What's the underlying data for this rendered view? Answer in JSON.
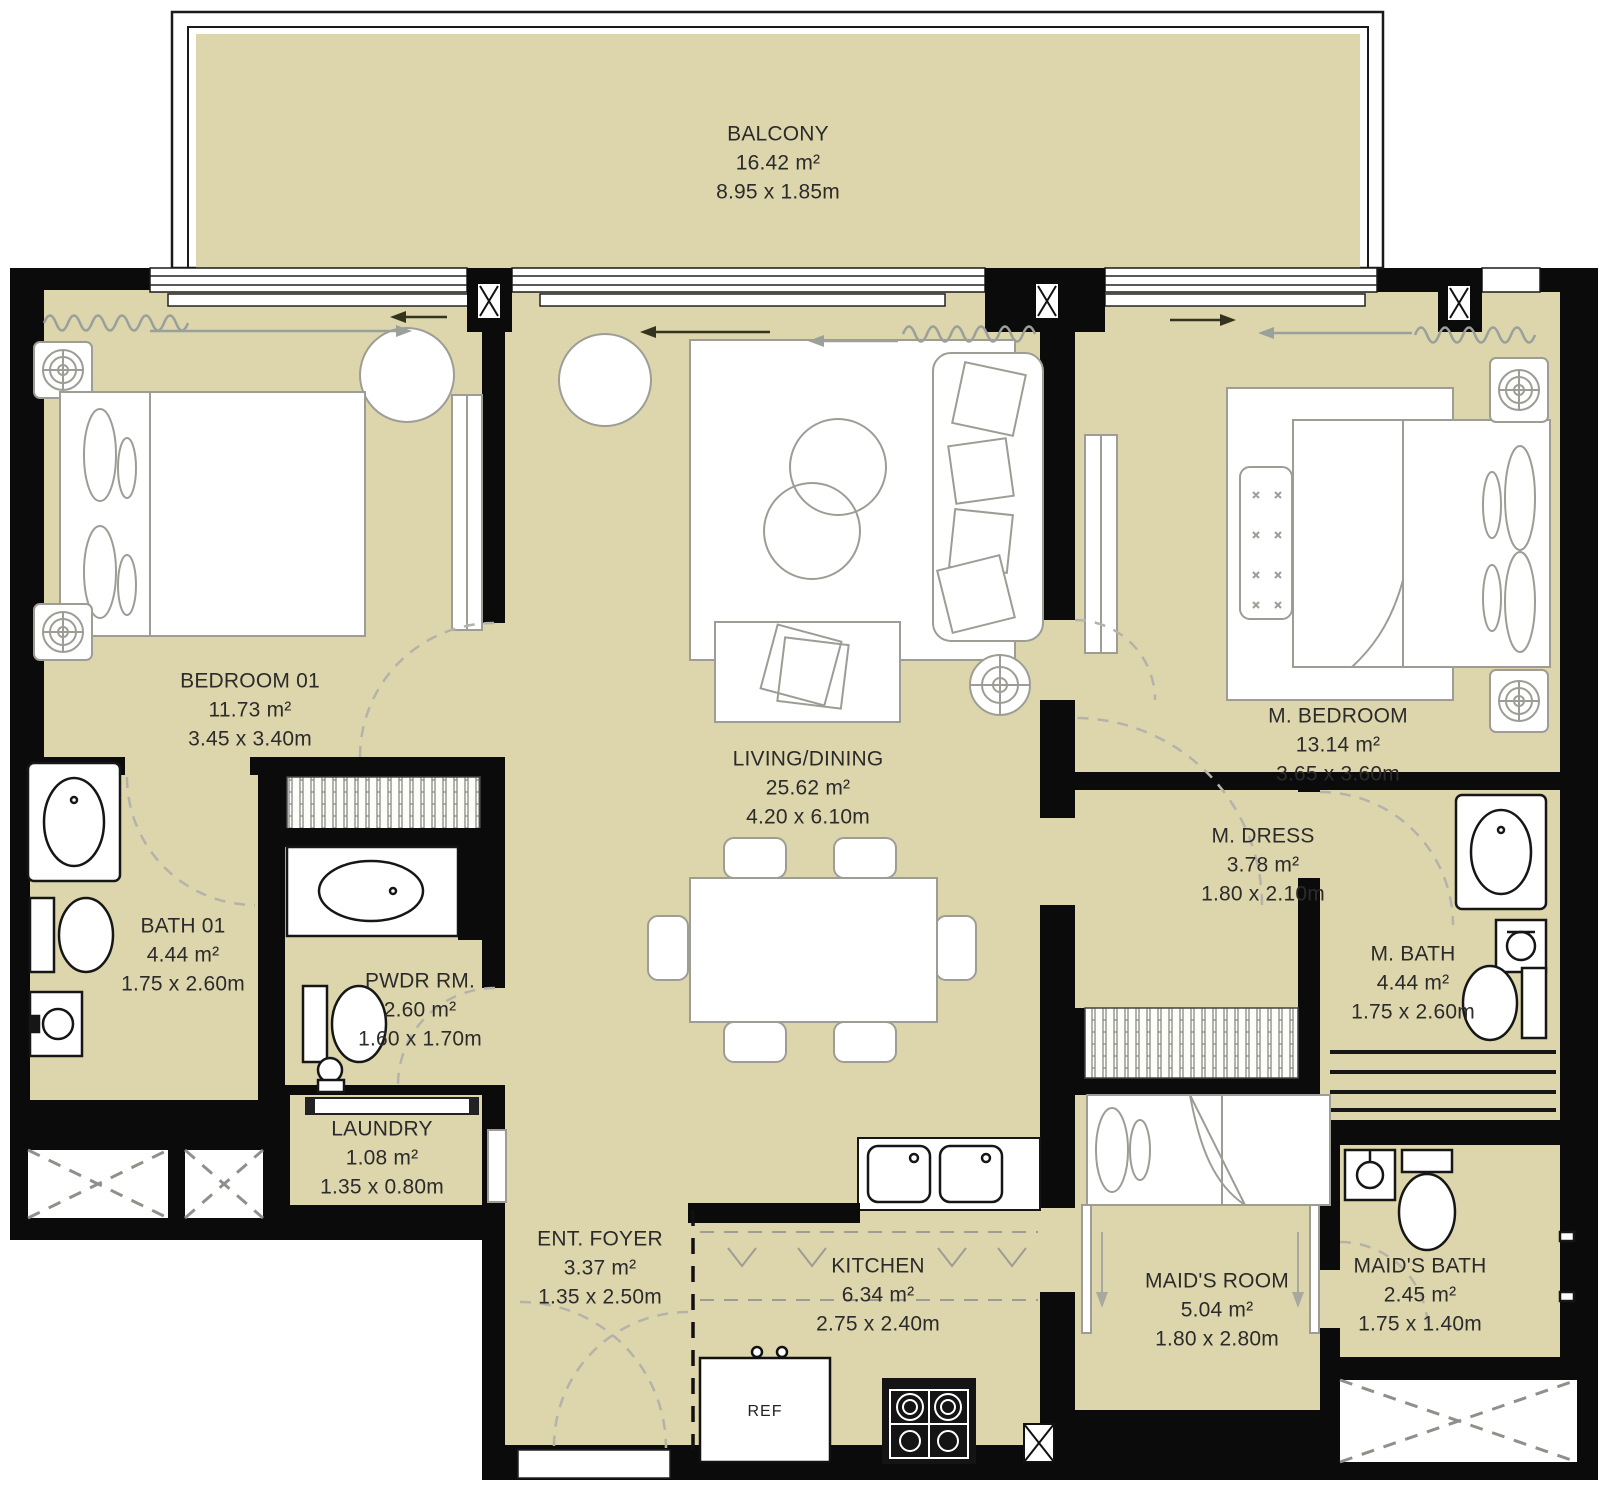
{
  "plan_type": "apartment-floor-plan",
  "rooms": [
    {
      "id": "balcony",
      "name": "BALCONY",
      "area": "16.42 m²",
      "dims": "8.95 x 1.85m"
    },
    {
      "id": "bedroom-01",
      "name": "BEDROOM 01",
      "area": "11.73 m²",
      "dims": "3.45 x 3.40m"
    },
    {
      "id": "bath-01",
      "name": "BATH 01",
      "area": "4.44 m²",
      "dims": "1.75 x 2.60m"
    },
    {
      "id": "powder-room",
      "name": "PWDR RM.",
      "area": "2.60 m²",
      "dims": "1.60 x 1.70m"
    },
    {
      "id": "laundry",
      "name": "LAUNDRY",
      "area": "1.08 m²",
      "dims": "1.35 x 0.80m"
    },
    {
      "id": "living-dining",
      "name": "LIVING/DINING",
      "area": "25.62 m²",
      "dims": "4.20 x 6.10m"
    },
    {
      "id": "entrance-foyer",
      "name": "ENT. FOYER",
      "area": "3.37 m²",
      "dims": "1.35 x 2.50m"
    },
    {
      "id": "kitchen",
      "name": "KITCHEN",
      "area": "6.34 m²",
      "dims": "2.75 x 2.40m"
    },
    {
      "id": "master-bedroom",
      "name": "M. BEDROOM",
      "area": "13.14 m²",
      "dims": "3.65 x 3.60m"
    },
    {
      "id": "master-dress",
      "name": "M. DRESS",
      "area": "3.78 m²",
      "dims": "1.80 x 2.10m"
    },
    {
      "id": "master-bath",
      "name": "M. BATH",
      "area": "4.44 m²",
      "dims": "1.75 x 2.60m"
    },
    {
      "id": "maids-room",
      "name": "MAID'S ROOM",
      "area": "5.04 m²",
      "dims": "1.80 x 2.80m"
    },
    {
      "id": "maids-bath",
      "name": "MAID'S BATH",
      "area": "2.45 m²",
      "dims": "1.75 x 1.40m"
    }
  ],
  "appliances": {
    "refrigerator": "REF"
  },
  "colors": {
    "floor": "#ddd6ac",
    "wall": "#0b0b0b",
    "furniture": "#9d9d95",
    "fixture": "#161616",
    "text": "#2b2b2b",
    "paper": "#ffffff"
  }
}
